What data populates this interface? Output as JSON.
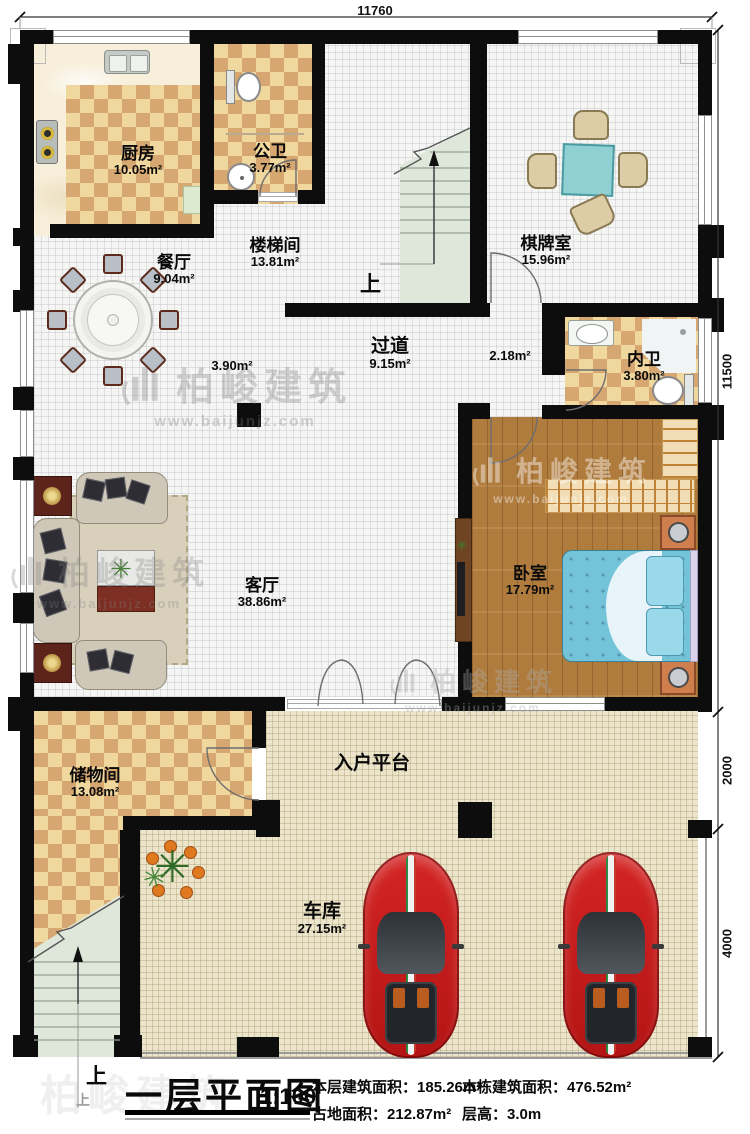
{
  "plan": {
    "title": "一层平面图",
    "scale": "1:100"
  },
  "info": [
    {
      "label": "本层建筑面积：",
      "value": "185.26m²"
    },
    {
      "label": "占地面积：",
      "value": "212.87m²"
    },
    {
      "label": "本栋建筑面积：",
      "value": "476.52m²"
    },
    {
      "label": "层高：",
      "value": "3.0m"
    }
  ],
  "dimensions": {
    "top_width": "11760",
    "right_house": "11500",
    "right_platform": "2000",
    "right_garage": "4000"
  },
  "rooms": [
    {
      "name": "厨房",
      "area": "10.05m²"
    },
    {
      "name": "公卫",
      "area": "3.77m²"
    },
    {
      "name": "楼梯间",
      "area": "13.81m²"
    },
    {
      "name": "棋牌室",
      "area": "15.96m²"
    },
    {
      "name": "餐厅",
      "area": "9.04m²"
    },
    {
      "name": "过道",
      "area": "9.15m²"
    },
    {
      "name": "内卫",
      "area": "3.80m²"
    },
    {
      "name": "卧室",
      "area": "17.79m²"
    },
    {
      "name": "客厅",
      "area": "38.86m²"
    },
    {
      "name": "储物间",
      "area": "13.08m²"
    },
    {
      "name": "入户平台",
      "area": ""
    },
    {
      "name": "车库",
      "area": "27.15m²"
    }
  ],
  "annotations": {
    "corridor_west": "3.90m²",
    "corridor_east": "2.18m²",
    "up": "上"
  },
  "watermark": {
    "brand": "柏峻建筑",
    "url": "www.baijunjz.com"
  },
  "colors": {
    "wall": "#0d0d0d",
    "checker_light": "#f0d79e",
    "checker_dark": "#d6a771",
    "wood": "#b27d3e",
    "bed_blue": "#74c4d9",
    "stair_sage": "#dfe7db",
    "outdoor_beige": "#ece5cb",
    "car_red": "#cf1d1d",
    "table_teal": "#8fd0d2"
  }
}
